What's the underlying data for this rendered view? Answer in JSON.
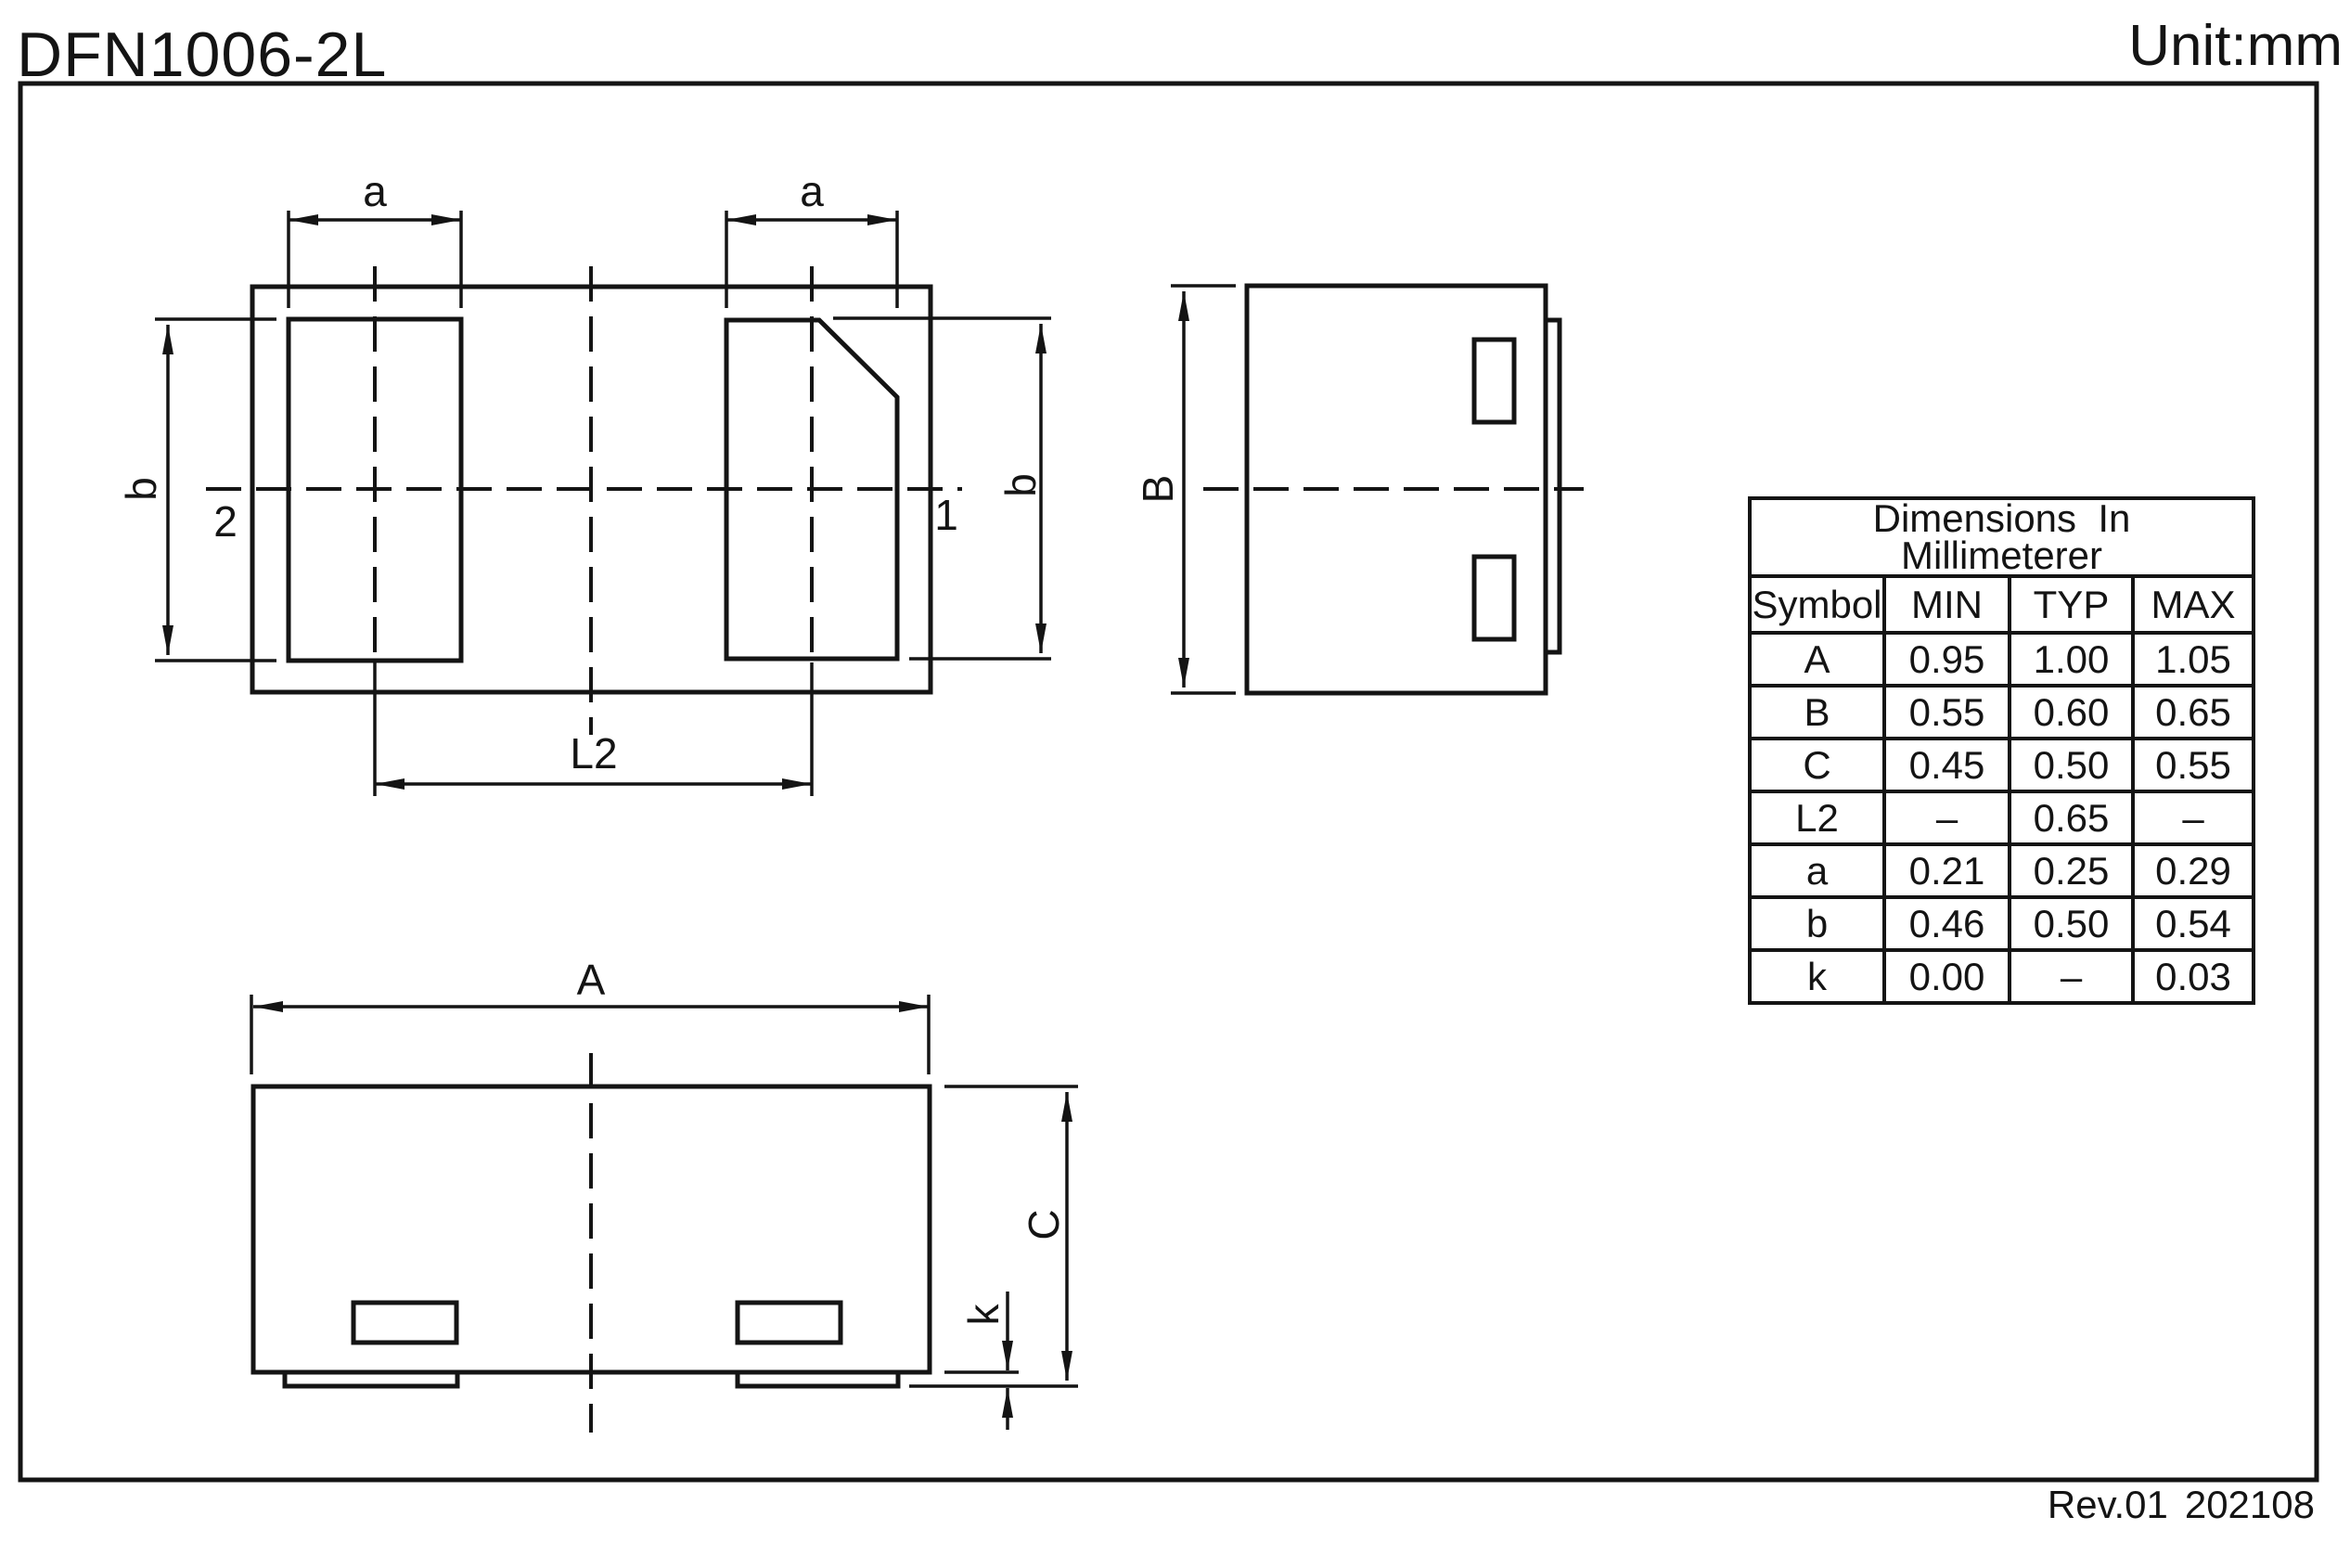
{
  "title": "DFN1006-2L",
  "unit_label": "Unit:mm",
  "footer": {
    "revision": "Rev.01",
    "date": "202108"
  },
  "views": {
    "top_view": {
      "labels": {
        "a_left": "a",
        "a_right": "a",
        "b_left": "b",
        "b_right": "b",
        "pin2": "2",
        "pin1": "1",
        "l2": "L2"
      }
    },
    "side_view": {
      "labels": {
        "B": "B"
      }
    },
    "front_view": {
      "labels": {
        "A": "A",
        "C": "C",
        "k": "k"
      }
    }
  },
  "table": {
    "title_line1": "Dimensions  In",
    "title_line2": "Millimeterer",
    "headers": [
      "Symbol",
      "MIN",
      "TYP",
      "MAX"
    ],
    "rows": [
      {
        "symbol": "A",
        "min": "0.95",
        "typ": "1.00",
        "max": "1.05"
      },
      {
        "symbol": "B",
        "min": "0.55",
        "typ": "0.60",
        "max": "0.65"
      },
      {
        "symbol": "C",
        "min": "0.45",
        "typ": "0.50",
        "max": "0.55"
      },
      {
        "symbol": "L2",
        "min": "–",
        "typ": "0.65",
        "max": "–"
      },
      {
        "symbol": "a",
        "min": "0.21",
        "typ": "0.25",
        "max": "0.29"
      },
      {
        "symbol": "b",
        "min": "0.46",
        "typ": "0.50",
        "max": "0.54"
      },
      {
        "symbol": "k",
        "min": "0.00",
        "typ": "–",
        "max": "0.03"
      }
    ]
  },
  "colors": {
    "ink": "#141414",
    "paper": "#ffffff"
  }
}
